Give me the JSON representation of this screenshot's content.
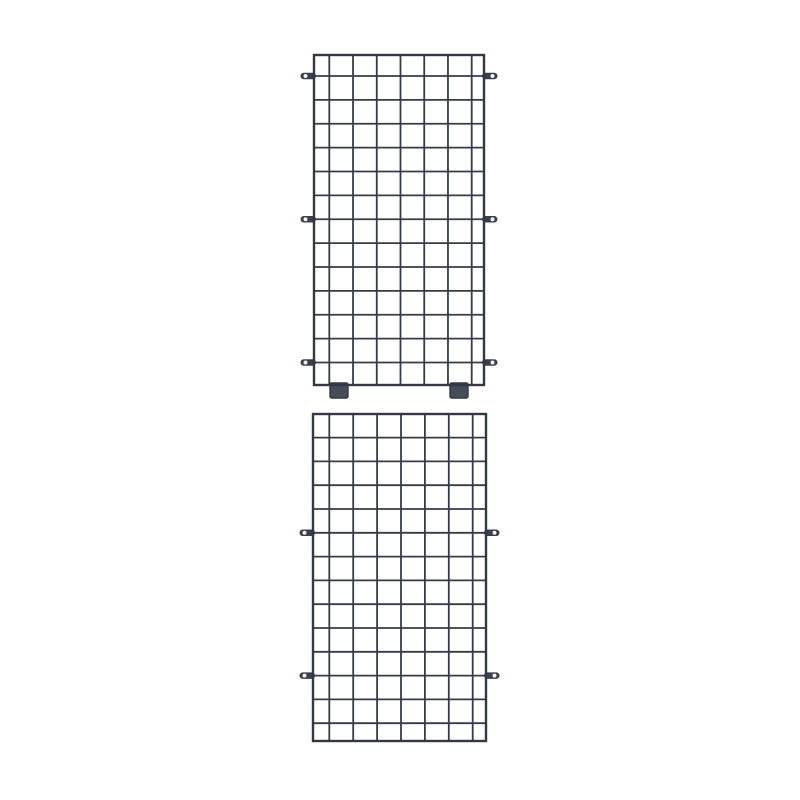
{
  "meta": {
    "description": "Product photo: two dark slate-gray wire mesh grid panels stacked vertically on a plain white background",
    "background": "#ffffff"
  },
  "colors": {
    "wire": "#353c46",
    "frame": "#323943",
    "tab_fill": "#39404a",
    "tab_hole": "#eef0f2",
    "foot_fill": "#454d58",
    "foot_edge": "#333a44"
  },
  "tab": {
    "length": 13.5,
    "thickness": 6.5,
    "hole_offset": 8.5,
    "hole_radius": 2
  },
  "foot": {
    "width": 18,
    "height": 13
  },
  "panels": [
    {
      "name": "wire-grid-panel-top",
      "label": "wire grid panel with two feet and three pairs of side mounting tabs",
      "x": 314,
      "y": 55,
      "width": 170,
      "height": 330,
      "cols": 8,
      "rows": 14,
      "left_inset": 15.3,
      "right_inset": 12.3,
      "top_inset": 21,
      "bottom_inset": 22.5,
      "tab_line_indices": [
        0,
        6,
        12
      ],
      "feet_centers": [
        25,
        145
      ]
    },
    {
      "name": "wire-grid-panel-bottom",
      "label": "wire grid panel with two pairs of side mounting tabs and no feet",
      "x": 313,
      "y": 414,
      "width": 173,
      "height": 327,
      "cols": 8,
      "rows": 14,
      "left_inset": 16.3,
      "right_inset": 13.3,
      "top_inset": 23.6,
      "bottom_inset": 17.8,
      "tab_line_indices": [
        4,
        10
      ],
      "feet_centers": []
    }
  ]
}
